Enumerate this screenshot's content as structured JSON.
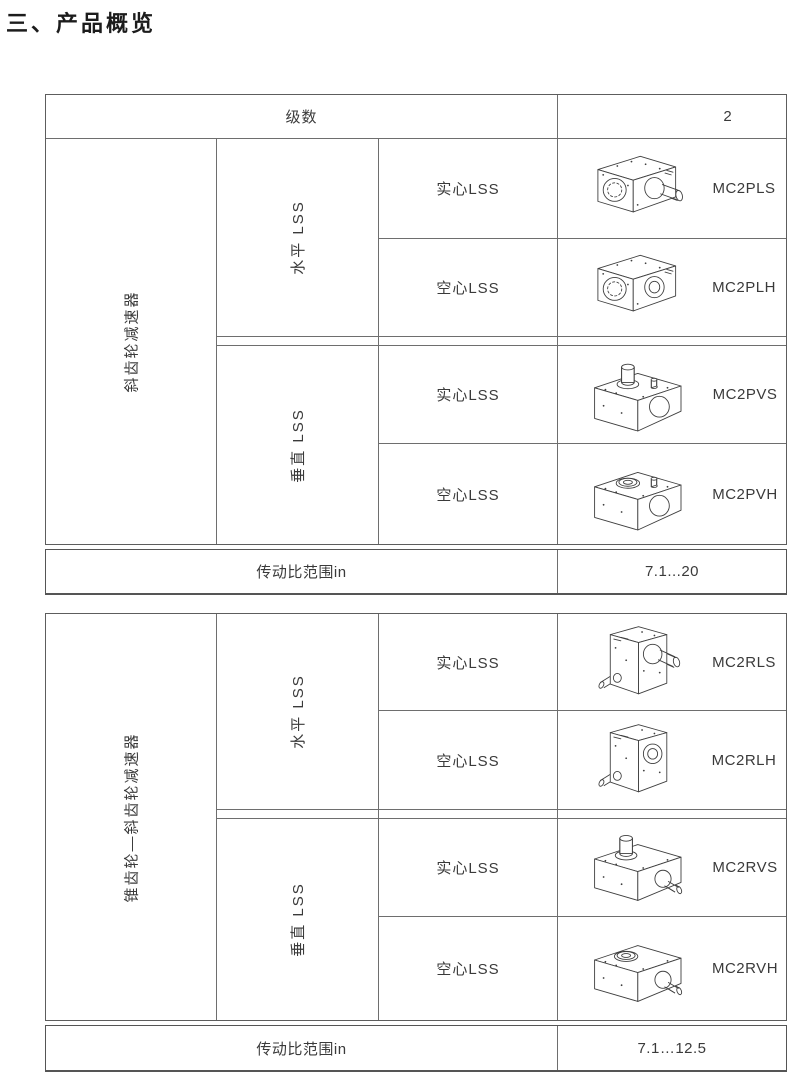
{
  "title": "三、产品概览",
  "colors": {
    "line": "#6e6e6e",
    "outer_line": "#555555",
    "text": "#3a3a3a"
  },
  "tables": [
    {
      "name": "斜齿轮减速器",
      "stages_label": "级数",
      "stages_value": "2",
      "sections": [
        {
          "orientation": "水平 LSS",
          "rows": [
            {
              "shaft": "实心LSS",
              "model": "MC2PLS",
              "image": "gearbox-horizontal-solid-shaft"
            },
            {
              "shaft": "空心LSS",
              "model": "MC2PLH",
              "image": "gearbox-horizontal-hollow-shaft"
            }
          ]
        },
        {
          "orientation": "垂直 LSS",
          "rows": [
            {
              "shaft": "实心LSS",
              "model": "MC2PVS",
              "image": "gearbox-vertical-solid-shaft"
            },
            {
              "shaft": "空心LSS",
              "model": "MC2PVH",
              "image": "gearbox-vertical-hollow-shaft"
            }
          ]
        }
      ],
      "ratio_label": "传动比范围in",
      "ratio_value": "7.1...20"
    },
    {
      "name": "锥齿轮—斜齿轮减速器",
      "sections": [
        {
          "orientation": "水平 LSS",
          "rows": [
            {
              "shaft": "实心LSS",
              "model": "MC2RLS",
              "image": "bevel-gearbox-horizontal-solid-shaft"
            },
            {
              "shaft": "空心LSS",
              "model": "MC2RLH",
              "image": "bevel-gearbox-horizontal-hollow-shaft"
            }
          ]
        },
        {
          "orientation": "垂直 LSS",
          "rows": [
            {
              "shaft": "实心LSS",
              "model": "MC2RVS",
              "image": "bevel-gearbox-vertical-solid-shaft"
            },
            {
              "shaft": "空心LSS",
              "model": "MC2RVH",
              "image": "bevel-gearbox-vertical-hollow-shaft"
            }
          ]
        }
      ],
      "ratio_label": "传动比范围in",
      "ratio_value": "7.1…12.5"
    }
  ]
}
